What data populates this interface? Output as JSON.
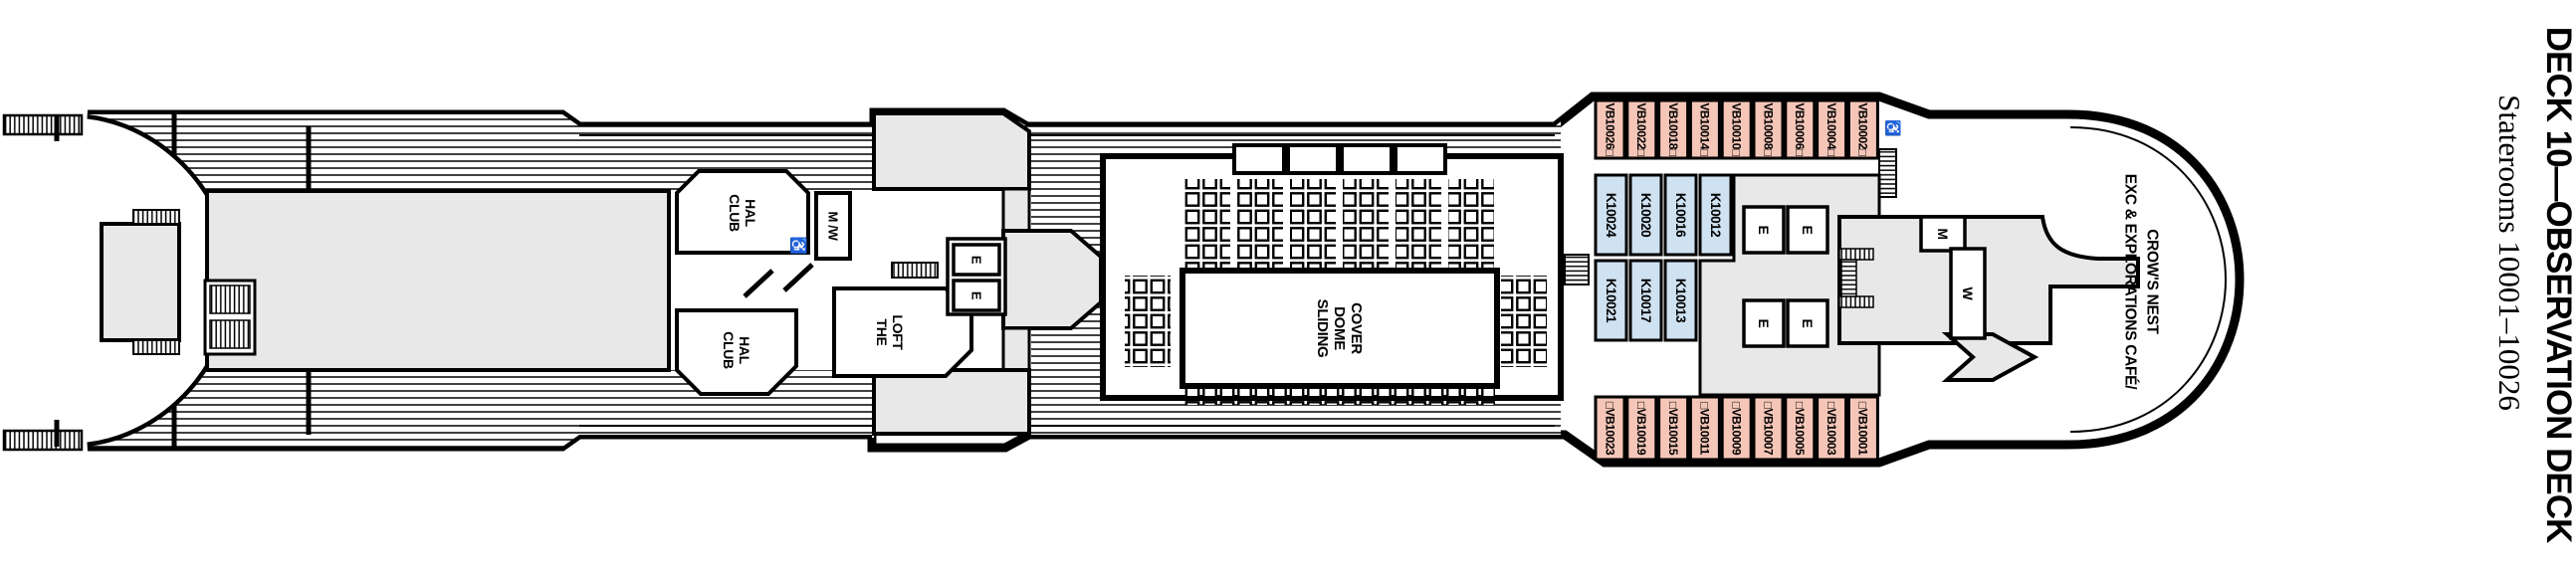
{
  "deck_plan": {
    "title": "DECK 10—OBSERVATION DECK",
    "subtitle": "Staterooms 10001–10026",
    "venues": {
      "club_hal_upper": [
        "CLUB",
        "HAL"
      ],
      "club_hal_lower": [
        "CLUB",
        "HAL"
      ],
      "restroom_mw": "M /W",
      "the_loft": [
        "THE",
        "LOFT"
      ],
      "sliding_dome": [
        "SLIDING",
        "DOME",
        "COVER"
      ],
      "crows_nest": [
        "EXC & EXPLORATIONS CAFÉ/",
        "CROW'S NEST"
      ],
      "mens": "M",
      "womens": "W",
      "elevator": "E",
      "accessible": "♿"
    },
    "staterooms": {
      "vb_color": "#f5c6b8",
      "k_color": "#cfe2f2",
      "top_row": [
        "VB10026□",
        "VB10022□",
        "VB10018□",
        "VB10014□",
        "VB10010□",
        "VB10008□",
        "VB10006□",
        "VB10004□",
        "VB10002□"
      ],
      "k_upper_row": [
        "K10024",
        "K10020",
        "K10016",
        "K10012"
      ],
      "k_lower_row": [
        "K10021",
        "K10017",
        "K10013"
      ],
      "bottom_row": [
        "□VB10023",
        "□VB10019",
        "□VB10015",
        "□VB10011",
        "□VB10009",
        "□VB10007",
        "□VB10005",
        "□VB10003",
        "□VB10001"
      ]
    }
  }
}
